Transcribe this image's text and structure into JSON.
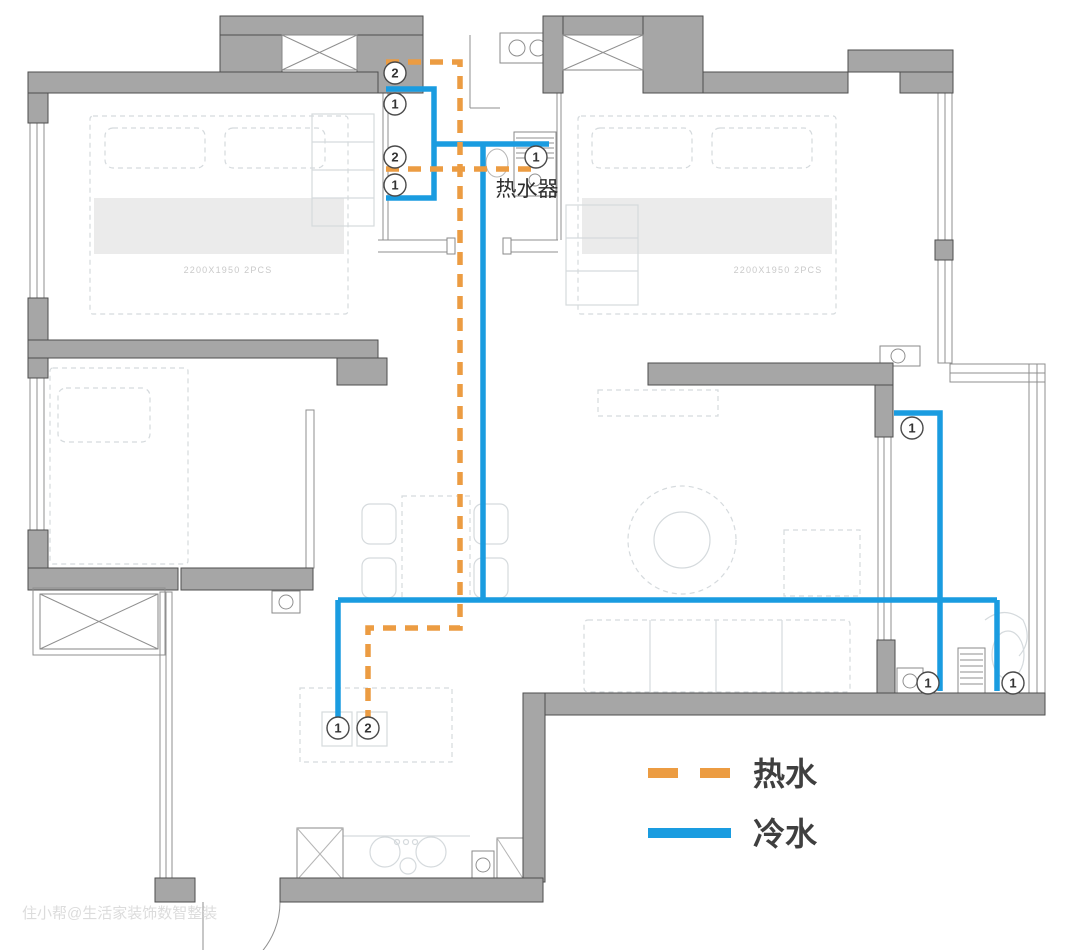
{
  "legend": {
    "items": [
      {
        "id": "hot",
        "label": "热水"
      },
      {
        "id": "cold",
        "label": "冷水"
      }
    ]
  },
  "labels": {
    "water_heater": "热水器",
    "bed_left": "2200X1950 2PCS",
    "bed_right": "2200X1950 2PCS",
    "watermark": "住小帮@生活家装饰数智整装"
  },
  "colors": {
    "hot": "#EC9C42",
    "cold": "#1A9CE0",
    "wall_fill": "#A6A6A6",
    "wall_stroke": "#4E4E4E",
    "faint": "#D5DADD",
    "marker_stroke": "#4A4A4A"
  },
  "pipes": {
    "cold": [
      [
        [
          386,
          89
        ],
        [
          434,
          89
        ],
        [
          434,
          198
        ],
        [
          386,
          198
        ]
      ],
      [
        [
          434,
          144
        ],
        [
          549,
          144
        ]
      ],
      [
        [
          483,
          144
        ],
        [
          483,
          600
        ]
      ],
      [
        [
          338,
          600
        ],
        [
          997,
          600
        ]
      ],
      [
        [
          338,
          600
        ],
        [
          338,
          719
        ]
      ],
      [
        [
          894,
          413
        ],
        [
          940,
          413
        ],
        [
          940,
          691
        ]
      ],
      [
        [
          997,
          600
        ],
        [
          997,
          691
        ]
      ]
    ],
    "hot": [
      [
        [
          386,
          62
        ],
        [
          460,
          62
        ],
        [
          460,
          628
        ],
        [
          368,
          628
        ],
        [
          368,
          719
        ]
      ],
      [
        [
          386,
          169
        ],
        [
          537,
          169
        ]
      ]
    ]
  },
  "markers": [
    {
      "x": 395,
      "y": 73,
      "n": "2"
    },
    {
      "x": 395,
      "y": 104,
      "n": "1"
    },
    {
      "x": 395,
      "y": 157,
      "n": "2"
    },
    {
      "x": 395,
      "y": 185,
      "n": "1"
    },
    {
      "x": 536,
      "y": 157,
      "n": "1"
    },
    {
      "x": 912,
      "y": 428,
      "n": "1"
    },
    {
      "x": 928,
      "y": 683,
      "n": "1"
    },
    {
      "x": 1013,
      "y": 683,
      "n": "1"
    },
    {
      "x": 338,
      "y": 728,
      "n": "1"
    },
    {
      "x": 368,
      "y": 728,
      "n": "2"
    }
  ]
}
